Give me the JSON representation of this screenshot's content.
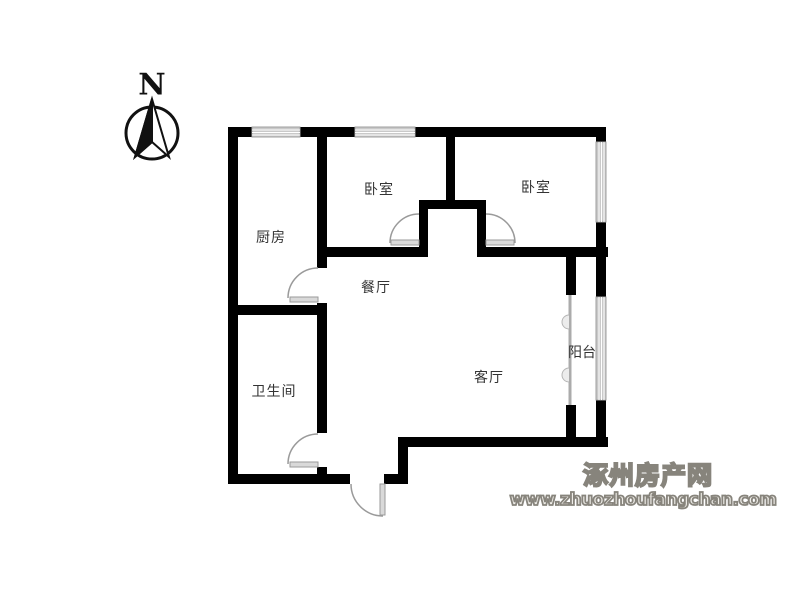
{
  "compass": {
    "north_label": "N"
  },
  "rooms": [
    {
      "id": "kitchen",
      "label": "厨房"
    },
    {
      "id": "bedroom-left",
      "label": "卧室"
    },
    {
      "id": "bedroom-right",
      "label": "卧室"
    },
    {
      "id": "dining",
      "label": "餐厅"
    },
    {
      "id": "bathroom",
      "label": "卫生间"
    },
    {
      "id": "living",
      "label": "客厅"
    },
    {
      "id": "balcony",
      "label": "阳台"
    }
  ],
  "watermark": {
    "site_name": "涿州房产网",
    "site_url": "www.zhuozhoufangchan.com"
  },
  "colors": {
    "wall": "#000000",
    "door_arc": "#9a9a9a",
    "door_leaf": "#d9d9d9",
    "window_fill": "#c9c9c9",
    "label_text": "#333333",
    "watermark_stroke": "#87847c",
    "watermark_fill": "#efede8",
    "background": "#ffffff"
  }
}
